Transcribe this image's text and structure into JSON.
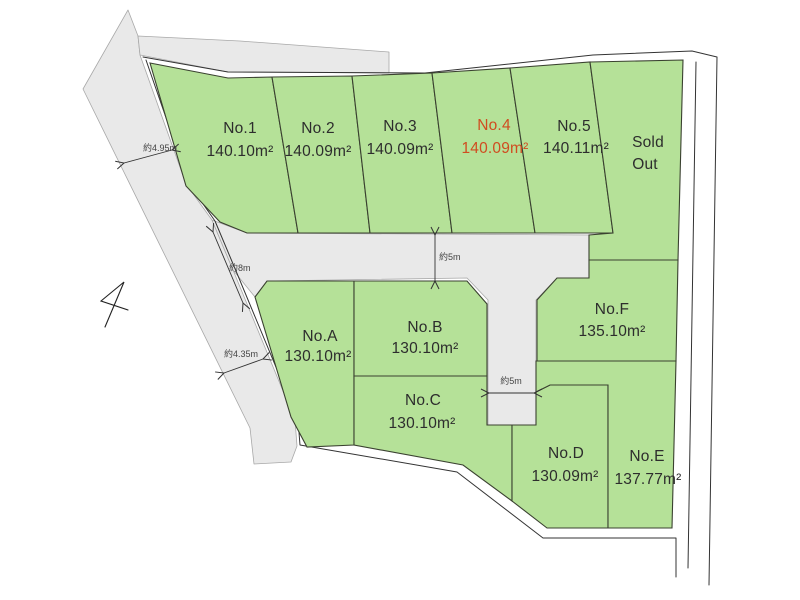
{
  "figure": {
    "type": "land-plot-subdivision-map",
    "lot_count_visible": 12
  },
  "lots": {
    "no1": {
      "name": "No.1",
      "area": "140.10m²"
    },
    "no2": {
      "name": "No.2",
      "area": "140.09m²"
    },
    "no3": {
      "name": "No.3",
      "area": "140.09m²"
    },
    "no4": {
      "name": "No.4",
      "area": "140.09m²",
      "highlighted": true
    },
    "no5": {
      "name": "No.5",
      "area": "140.11m²"
    },
    "sold": {
      "line1": "Sold",
      "line2": "Out"
    },
    "noA": {
      "name": "No.A",
      "area": "130.10m²"
    },
    "noB": {
      "name": "No.B",
      "area": "130.10m²"
    },
    "noC": {
      "name": "No.C",
      "area": "130.10m²"
    },
    "noD": {
      "name": "No.D",
      "area": "130.09m²"
    },
    "noE": {
      "name": "No.E",
      "area": "137.77m²"
    },
    "noF": {
      "name": "No.F",
      "area": "135.10m²"
    }
  },
  "measurements": {
    "left_top": "約4.95m",
    "left_mid": "約8m",
    "road_top": "約5m",
    "left_bottom": "約4.35m",
    "road_stub": "約5m"
  },
  "colors": {
    "lot_fill": "#b5e198",
    "lot_stroke": "#3a4130",
    "road_fill": "#e9e9e9",
    "road_stroke": "#a8a8a8",
    "boundary": "#333333",
    "highlight": "#d04c20",
    "label_text": "#2d2d2d",
    "measure_text": "#444444",
    "background": "#ffffff"
  }
}
